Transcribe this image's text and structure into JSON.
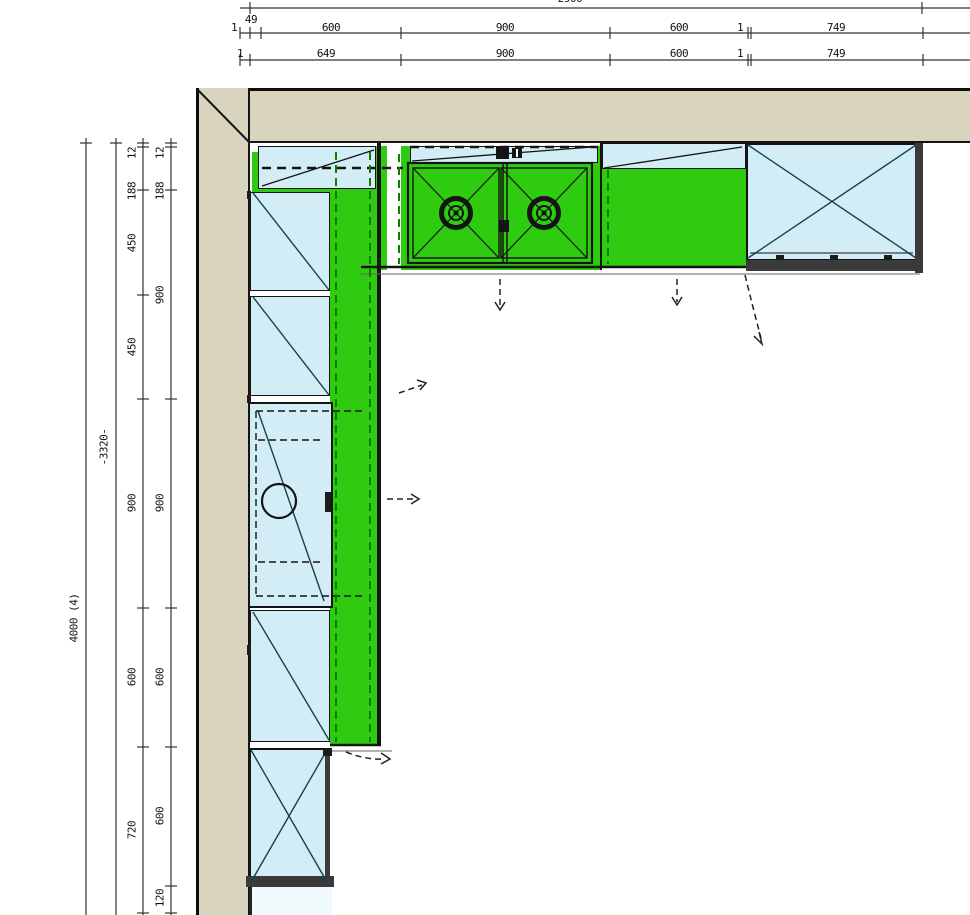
{
  "drawing": {
    "kind": "kitchen-floor-plan",
    "burner_count": 2,
    "sink_count": 1
  },
  "colors": {
    "wall": "#d9d4be",
    "counter_green": "#2fcb10",
    "cabinet_blue": "#d2edf6",
    "cabinet_pale": "#f0f9fc",
    "line": "#141414",
    "dashed_green": "#0e7d00"
  },
  "dims": {
    "top": {
      "total": "2900",
      "row1": [
        "1",
        "49",
        "600",
        "900",
        "600",
        "1",
        "749"
      ],
      "row2": [
        "1",
        "649",
        "900",
        "600",
        "1",
        "749"
      ]
    },
    "left": {
      "overall": "4000 (4)",
      "chain": "-3320-",
      "outer": [
        "12",
        "188",
        "450",
        "450",
        "900",
        "600",
        "720"
      ],
      "inner": [
        "12",
        "188",
        "900",
        "900",
        "600",
        "600",
        "120"
      ]
    }
  }
}
